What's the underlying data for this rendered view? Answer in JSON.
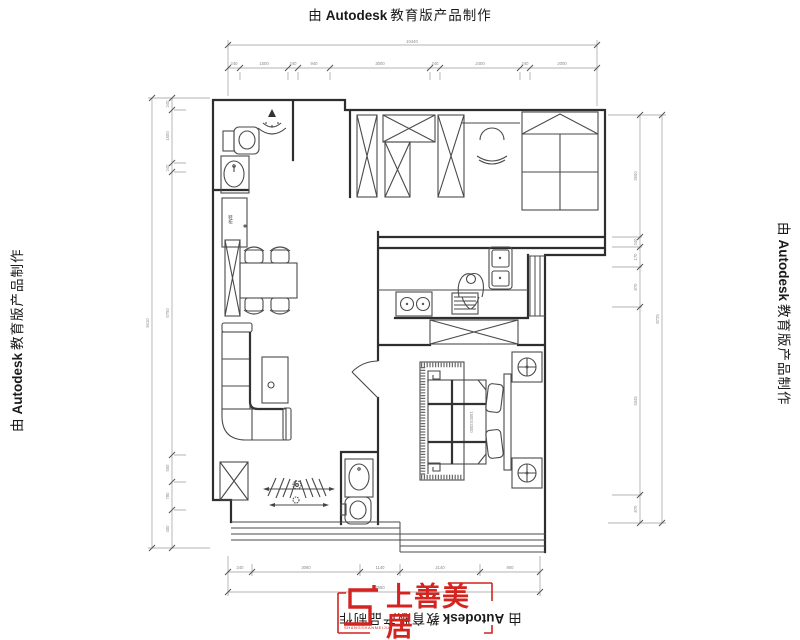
{
  "watermark": {
    "prefix": "由",
    "brand": "Autodesk",
    "suffix": "教育版产品制作"
  },
  "logo": {
    "name": "上善美居",
    "subtext": "SHANGSHANMEIJU",
    "accent_color": "#d42420"
  },
  "plan": {
    "labels": {
      "shoe_cabinet": "鞋柜",
      "bed_size": "1500X2000"
    }
  },
  "dims": {
    "top": {
      "total": "10440",
      "segments": [
        "240",
        "1500",
        "240",
        "940",
        "3000",
        "240",
        "2400",
        "240",
        "2000"
      ]
    },
    "bottom": {
      "total": "7580",
      "segments": [
        "240",
        "3060",
        "1140",
        "2140",
        "900"
      ]
    },
    "left": {
      "total": "9410",
      "segments": [
        "240",
        "1500",
        "240",
        "5750",
        "500",
        "780",
        "400"
      ]
    },
    "right": {
      "total": "8725",
      "segments": [
        "2600",
        "240",
        "170",
        "870",
        "3345",
        "870"
      ]
    }
  }
}
